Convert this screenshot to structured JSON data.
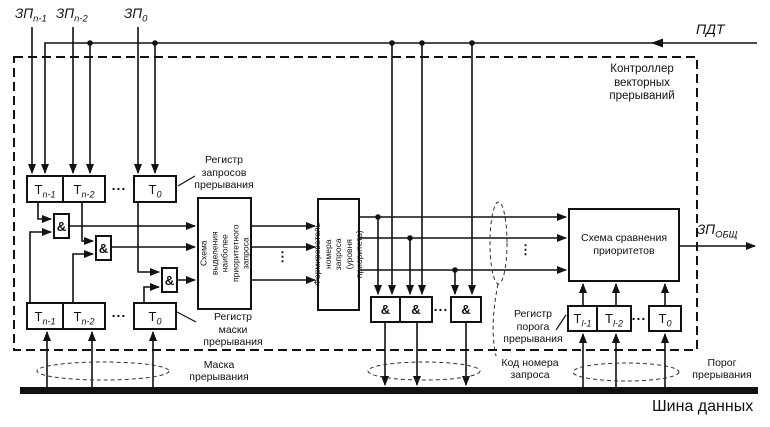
{
  "inputs": {
    "zp_n1": {
      "base": "ЗП",
      "sub": "n-1"
    },
    "zp_n2": {
      "base": "ЗП",
      "sub": "n-2"
    },
    "zp_0": {
      "base": "ЗП",
      "sub": "0"
    },
    "pdt": "ПДТ"
  },
  "output": {
    "zp_total": {
      "base": "ЗП",
      "sub": "ОБЩ"
    }
  },
  "controller_caption": "Контроллер\nвекторных\nпрерываний",
  "request_register": {
    "caption": "Регистр\nзапросов\nпрерывания",
    "cells": [
      {
        "base": "Т",
        "sub": "n-1"
      },
      {
        "base": "Т",
        "sub": "n-2"
      },
      {
        "base": "Т",
        "sub": "0"
      }
    ]
  },
  "mask_register": {
    "caption": "Регистр\nмаски\nпрерывания",
    "cells": [
      {
        "base": "Т",
        "sub": "n-1"
      },
      {
        "base": "Т",
        "sub": "n-2"
      },
      {
        "base": "Т",
        "sub": "0"
      }
    ]
  },
  "threshold_register": {
    "caption": "Регистр\nпорога\nпрерывания",
    "cells": [
      {
        "base": "Т",
        "sub": "l-1"
      },
      {
        "base": "Т",
        "sub": "l-2"
      },
      {
        "base": "Т",
        "sub": "0"
      }
    ]
  },
  "blocks": {
    "selector": "Схема выделения\nнаиболее\nприоритетного\nзапроса",
    "former": "Формирователь\nномера запроса\n(уровня приоритета)",
    "comparator": "Схема сравнения\nприоритетов"
  },
  "gate_label": "&",
  "bus": {
    "mask": "Маска\nпрерывания",
    "code": "Код номера\nзапроса",
    "threshold": "Порог\nпрерывания",
    "name": "Шина данных"
  },
  "ellipsis": {
    "h": "...",
    "v": "⋮"
  }
}
